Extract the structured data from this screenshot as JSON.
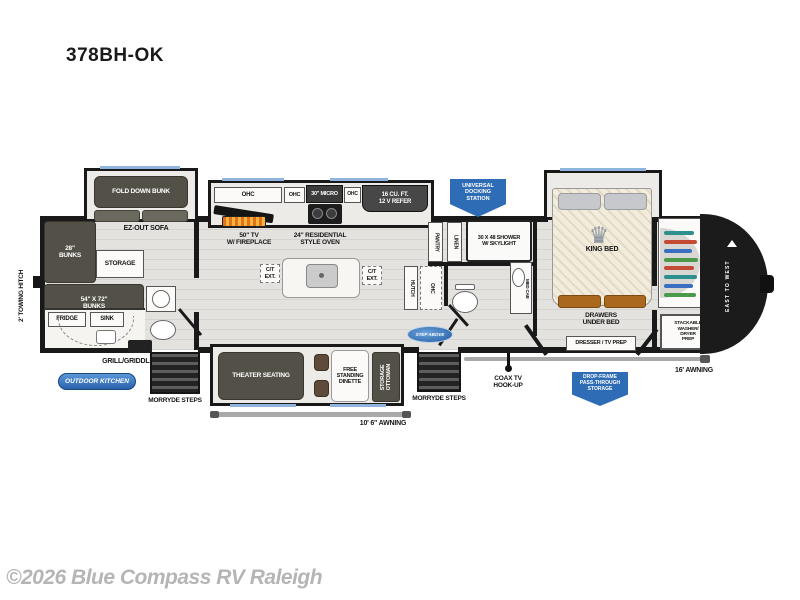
{
  "title": "378BH-OK",
  "copyright": "©2026 Blue Compass RV Raleigh",
  "labels": {
    "towing_hitch": "2' TOWING HITCH",
    "fold_down_bunk": "FOLD DOWN BUNK",
    "ez_out_sofa": "EZ-OUT SOFA",
    "bunks_28": "28\"\nBUNKS",
    "bunks_54": "54\" X 72\"\nBUNKS",
    "storage": "STORAGE",
    "fridge": "FRIDGE",
    "sink": "SINK",
    "grill": "GRILL/GRIDDLE",
    "steps_rear": "MORRYDE STEPS",
    "steps_main": "MORRYDE STEPS",
    "ohc_a": "OHC",
    "ohc_b": "OHC",
    "ohc_c": "OHC",
    "micro": "30\" MICRO",
    "refer": "16 CU. FT.\n12 V REFER",
    "tv_fireplace": "50\" TV\nW/ FIREPLACE",
    "oven": "24\" RESIDENTIAL\nSTYLE OVEN",
    "ct_ext_l": "C/T\nEXT.",
    "ct_ext_r": "C/T\nEXT.",
    "theater": "THEATER SEATING",
    "dinette": "FREE\nSTANDING\nDINETTE",
    "ottoman": "STORAGE\nOTTOMAN",
    "awning_main": "10' 6\" AWNING",
    "awning_front": "16' AWNING",
    "pantry": "PANTRY",
    "linen": "LINEN",
    "shower": "30 X 48 SHOWER\nW/ SKYLIGHT",
    "hutch": "HUTCH",
    "ohc_vert": "OHC",
    "med_cab": "MED CAB",
    "king_bed": "KING BED",
    "drawers": "DRAWERS\nUNDER BED",
    "dresser": "DRESSER / TV PREP",
    "washer": "STACKABLE\nWASHER/\nDRYER\nPREP",
    "coax": "COAX TV\nHOOK-UP"
  },
  "badges": {
    "docking": "UNIVERSAL\nDOCKING\nSTATION",
    "outdoor_kitchen": "OUTDOOR KITCHEN",
    "drop_frame": "DROP-FRAME\nPASS-THROUGH\nSTORAGE",
    "step_above": "STEP ABOVE",
    "east_to_west": "EAST TO WEST"
  },
  "colors": {
    "badge_blue": "#2e6db6",
    "wall_black": "#191919",
    "furniture_olive": "#535147",
    "window_blue": "#8fb4de"
  }
}
